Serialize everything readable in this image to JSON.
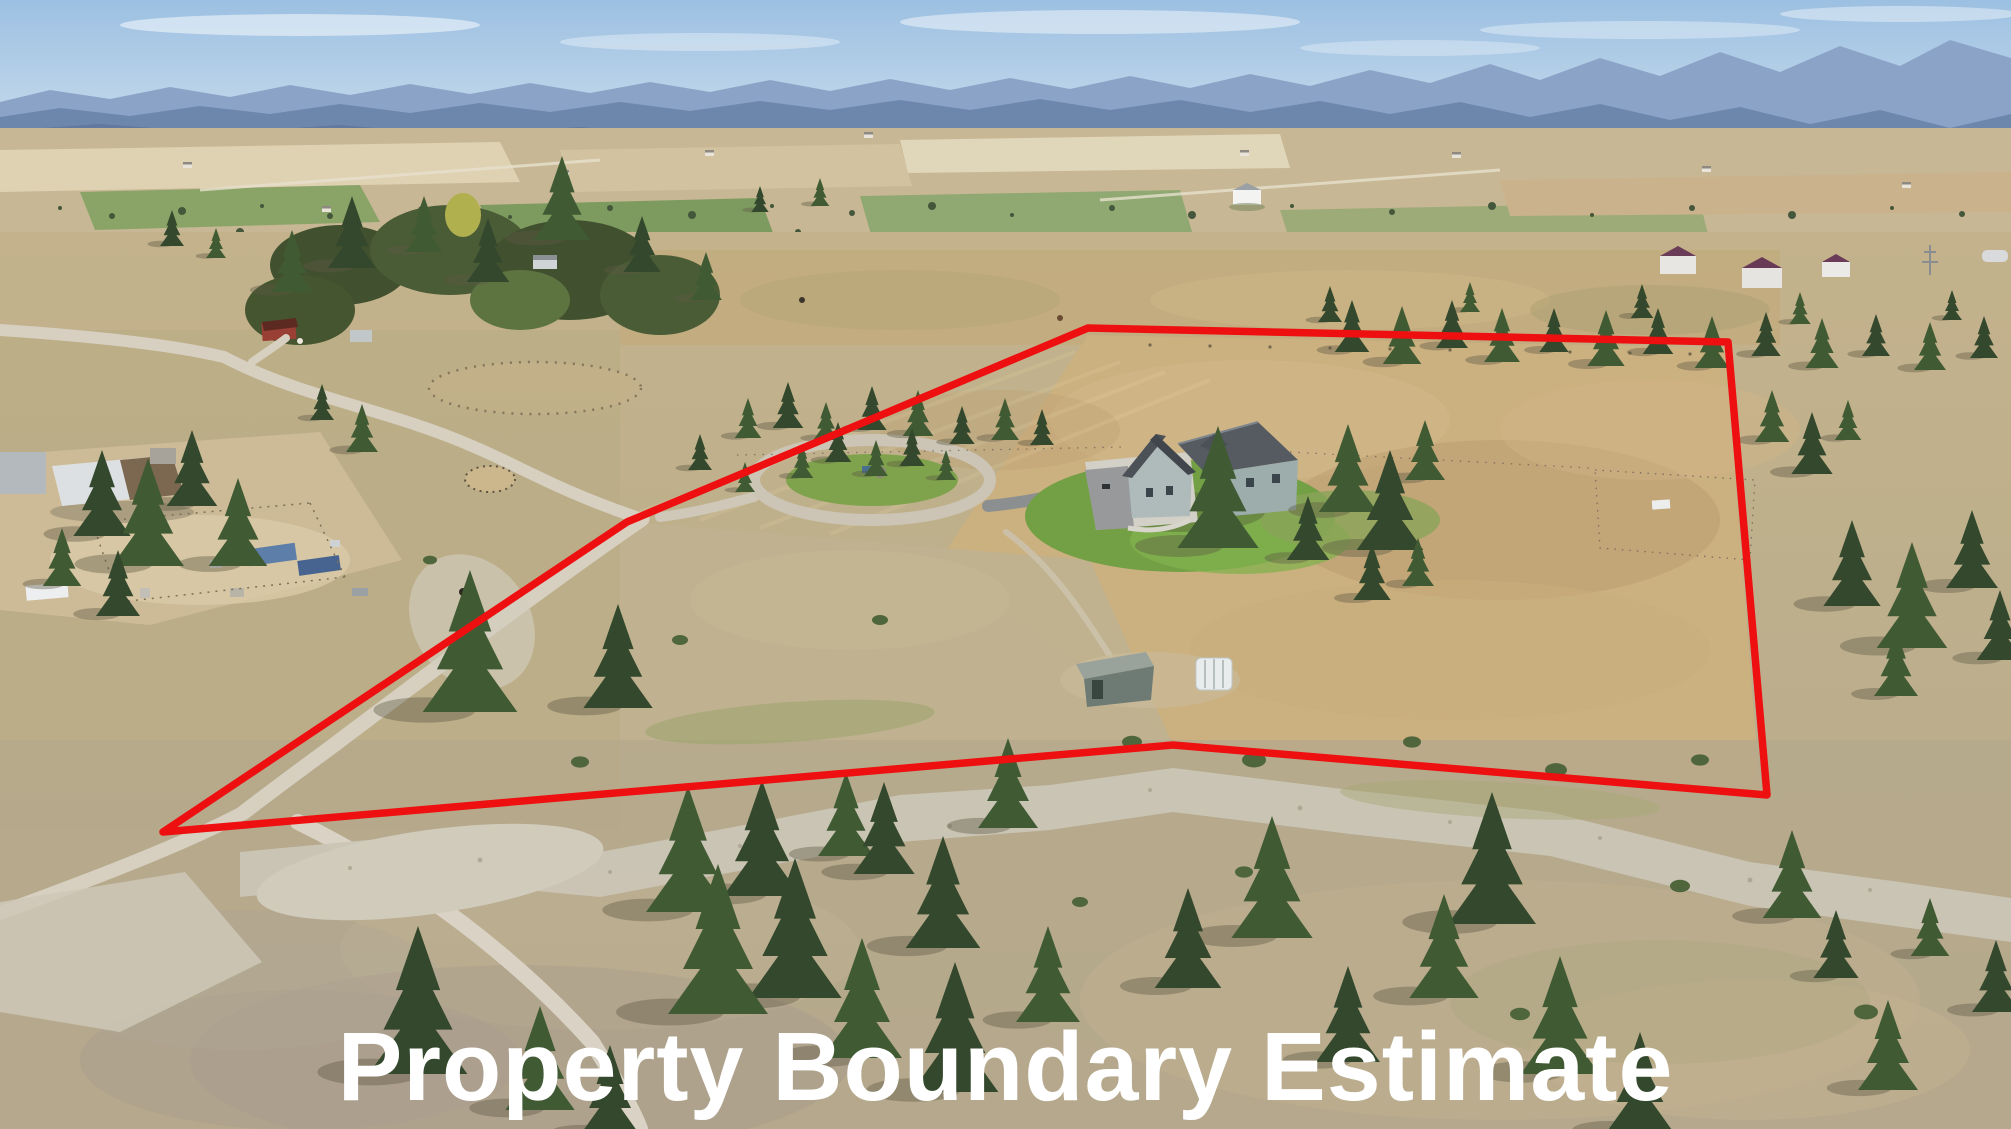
{
  "caption": {
    "text": "Property Boundary Estimate",
    "color": "#ffffff"
  },
  "boundary": {
    "points": "163,832 627,522 1088,328 1728,342 1767,795 1173,745",
    "color": "#ee1010",
    "stroke_width": 7.5
  },
  "scene": {
    "sky_color": "#a9c8e2",
    "mountain_color": "#8ca3c8",
    "pasture_color": "#c9ae80",
    "tree_color": "#3f5a34",
    "road_color": "#d7d0c1",
    "house_roof_color": "#555b61",
    "house_wall_color": "#9cadac"
  }
}
